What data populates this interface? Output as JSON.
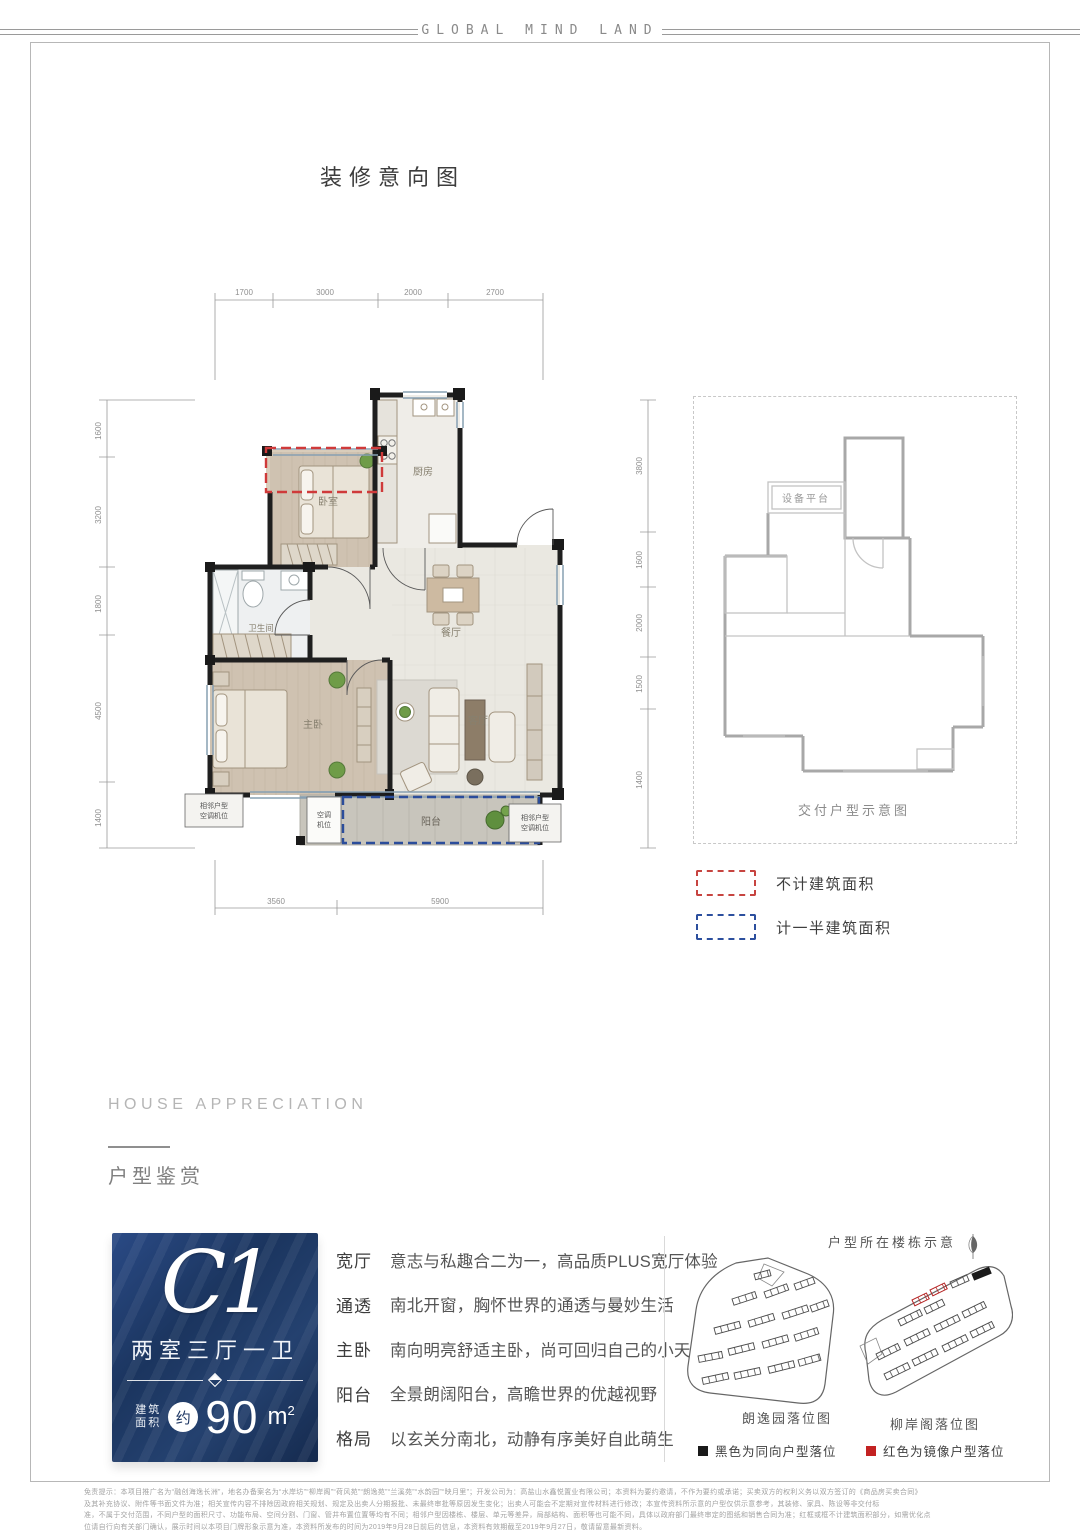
{
  "brand": "GLOBAL MIND LAND",
  "main_title": "装修意向图",
  "floor_plan": {
    "dims_top": [
      "1700",
      "3000",
      "2000",
      "2700"
    ],
    "dims_bottom": [
      "3560",
      "5900"
    ],
    "dims_left": [
      "1600",
      "3200",
      "1800",
      "4500",
      "1400"
    ],
    "dims_right": [
      "3800",
      "1600",
      "2000",
      "1500",
      "1400"
    ],
    "rooms": {
      "bedroom": "卧室",
      "kitchen": "厨房",
      "bathroom": "卫生间",
      "master": "主卧",
      "dining": "餐厅",
      "living": "客厅",
      "balcony": "阳台"
    },
    "ac_adjacent_line1": "相邻户型",
    "ac_adjacent_line2": "空调机位",
    "ac_mid_line1": "空调",
    "ac_mid_line2": "机位"
  },
  "delivery_plan": {
    "platform_label": "设备平台",
    "caption": "交付户型示意图"
  },
  "area_legend": {
    "red_label": "不计建筑面积",
    "blue_label": "计一半建筑面积",
    "red": "#c74440",
    "blue": "#2c4f9e"
  },
  "section_header": {
    "en": "HOUSE APPRECIATION",
    "cn": "户型鉴赏"
  },
  "unit_card": {
    "code": "C1",
    "layout": "两室三厅一卫",
    "area_prefix_line1": "建筑",
    "area_prefix_line2": "面积",
    "approx": "约",
    "area_value": "90",
    "area_unit": "m",
    "area_exp": "2",
    "bg": "#1d3663"
  },
  "features": [
    {
      "label": "宽厅",
      "desc": "意志与私趣合二为一，高品质PLUS宽厅体验"
    },
    {
      "label": "通透",
      "desc": "南北开窗，胸怀世界的通透与曼妙生活"
    },
    {
      "label": "主卧",
      "desc": "南向明亮舒适主卧，尚可回归自己的小天地"
    },
    {
      "label": "阳台",
      "desc": "全景朗阔阳台，高瞻世界的优越视野"
    },
    {
      "label": "格局",
      "desc": "以玄关分南北，动静有序美好自此萌生"
    }
  ],
  "building_maps": {
    "title": "户型所在楼栋示意",
    "map1_caption": "朗逸园落位图",
    "map2_caption": "柳岸阁落位图",
    "legend_black": "黑色为同向户型落位",
    "legend_red": "红色为镜像户型落位",
    "black": "#1a1a1a",
    "red_color": "#c32222"
  },
  "disclaimer": {
    "lines": [
      "免责提示：本项目推广名为“融创海逸长洲”，地名办备案名为“水岸坊”“柳岸阁”“荷风苑”“朗逸苑”“兰溪苑”“水韵园”“映月里”；开发公司为：高盐山水鑫悦置业有限公司；本资料为要约邀请，不作为要约或承诺；买卖双方的权利义务以双方签订的《商品房买卖合同》",
      "及其补充协议、附件等书面文件为准；相关宣传内容不排除因政府相关规划、规定及出卖人分期报批、未最终审批等原因发生变化；出卖人可能会不定期对宣传材料进行修改；本宣传资料所示意的户型仅供示意参考，其装修、家具、陈设等非交付标",
      "准，不属于交付范围，不同户型的面积尺寸、功能布局、空间分割、门窗、管井布置位置等均有不同；相邻户型因楼栋、楼层、单元等差异，局部结构、面积等也可能不同，具体以政府部门最终审定的图纸和销售合同为准；红框或框不计建筑面积部分，如需优化点",
      "位请自行向有关部门确认，展示时间以本项目门牌形象示意为准，本资料所发布的时间为2019年9月28日前后的信息，本资料有效期截至2019年9月27日，敬请留意最新资料。"
    ]
  }
}
